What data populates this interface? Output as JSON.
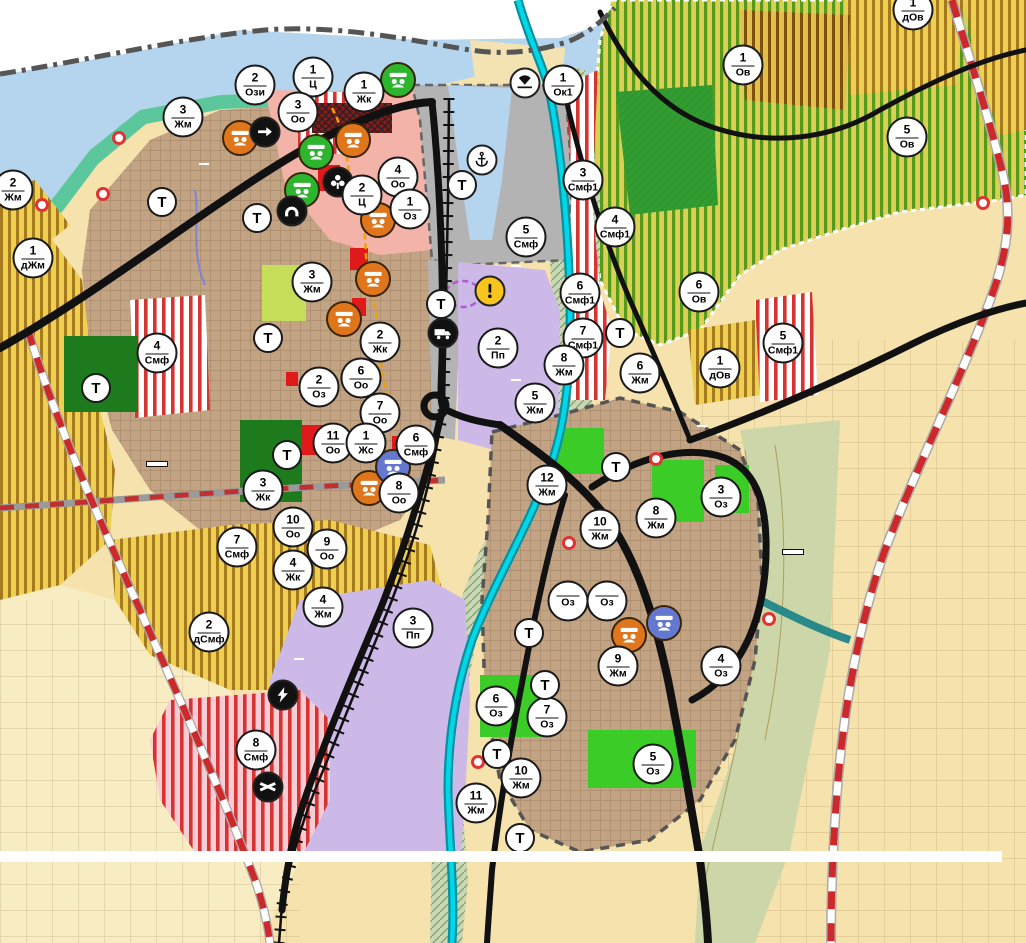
{
  "palette": {
    "river_blue": "#b5d5ee",
    "urban_brown": "#c2a384",
    "fields_peach": "#f6e2ad",
    "orchard_green": "#d8d154",
    "vineyard_yellow": "#eed04e",
    "mixed_use_red": "#d63333",
    "industrial_purple": "#cdb9e8",
    "port_gray": "#b3b3b3",
    "park_green": "#3ccc28",
    "dark_green": "#1d7a1d",
    "road_black": "#111111",
    "republican_road_red": "#c03030",
    "water_cyan": "#00d8e8",
    "center_pink": "#f3b3a9",
    "shore_teal": "#5cc79c",
    "warning_yellow": "#f7c51e"
  },
  "map": {
    "place_labels": [
      {
        "text": "ЛОМ",
        "x": 172,
        "y": 420,
        "cls": "city"
      },
      {
        "text": "ЛОМ",
        "x": 797,
        "y": 499,
        "cls": "city"
      },
      {
        "text": "кв. Младеново",
        "x": 800,
        "y": 525,
        "cls": "quarter"
      },
      {
        "text": "р. Дунав",
        "x": 417,
        "y": 14,
        "cls": "river-label"
      },
      {
        "text": "Пристанищен\nтерминал Лом",
        "x": 341,
        "y": 57,
        "cls": "port-label"
      }
    ],
    "street_labels": [
      {
        "text": "ул. \"А. СТАМБОЛИЙСКИ\"",
        "x": 204,
        "y": 164,
        "size": 20
      },
      {
        "text": "ул. \"ПРИСТАНИЩНА\"",
        "x": 516,
        "y": 266,
        "size": 20
      },
      {
        "text": "НАДЛЕЗ И МОСТ",
        "x": 516,
        "y": 380,
        "size": 21
      },
      {
        "text": "ул. \"КОВАЧИШКА\"",
        "x": 702,
        "y": 426,
        "size": 20
      },
      {
        "text": "ул. \"СОФИЙСКА\"",
        "x": 604,
        "y": 587,
        "size": 21
      },
      {
        "text": "ул. \"БЕЛОГРАДЧИШКО ШОСЕ\"",
        "x": 299,
        "y": 659,
        "size": 20
      }
    ],
    "road_labels": [
      {
        "text": "MON3138",
        "x": 618,
        "y": 42,
        "rotate": -33
      },
      {
        "text": "MON2135",
        "x": 656,
        "y": 258,
        "rotate": -62
      },
      {
        "text": "MON3139",
        "x": 158,
        "y": 490,
        "rotate": 7
      },
      {
        "text": "MON2136",
        "x": 497,
        "y": 797,
        "rotate": -78
      },
      {
        "text": "II-11",
        "x": 925,
        "y": 304,
        "rotate": 10,
        "cls": "big"
      }
    ],
    "land_boxes": [
      {
        "text": "Землище\n44238",
        "x": 157,
        "y": 464
      },
      {
        "text": "Землище\n44238",
        "x": 793,
        "y": 552
      }
    ],
    "zone_markers": [
      {
        "num": "2",
        "code": "Ози",
        "x": 255,
        "y": 85
      },
      {
        "num": "1",
        "code": "Ц",
        "x": 313,
        "y": 77
      },
      {
        "num": "1",
        "code": "Жк",
        "x": 364,
        "y": 92
      },
      {
        "num": "3",
        "code": "Оо",
        "x": 298,
        "y": 112
      },
      {
        "num": "3",
        "code": "Жм",
        "x": 183,
        "y": 117
      },
      {
        "num": "2",
        "code": "Жм",
        "x": 13,
        "y": 190
      },
      {
        "num": "1",
        "code": "дЖм",
        "x": 33,
        "y": 258
      },
      {
        "num": "4",
        "code": "Оо",
        "x": 398,
        "y": 177
      },
      {
        "num": "2",
        "code": "Ц",
        "x": 362,
        "y": 195
      },
      {
        "num": "1",
        "code": "Оз",
        "x": 410,
        "y": 209
      },
      {
        "num": "1",
        "code": "Ок1",
        "x": 563,
        "y": 85
      },
      {
        "num": "3",
        "code": "Смф1",
        "x": 583,
        "y": 180
      },
      {
        "num": "4",
        "code": "Смф1",
        "x": 615,
        "y": 227
      },
      {
        "num": "5",
        "code": "Смф",
        "x": 526,
        "y": 237
      },
      {
        "num": "1",
        "code": "Ов",
        "x": 743,
        "y": 65
      },
      {
        "num": "1",
        "code": "дОв",
        "x": 913,
        "y": 10
      },
      {
        "num": "5",
        "code": "Ов",
        "x": 907,
        "y": 137
      },
      {
        "num": "6",
        "code": "Ов",
        "x": 699,
        "y": 292
      },
      {
        "num": "1",
        "code": "дОв",
        "x": 720,
        "y": 368
      },
      {
        "num": "5",
        "code": "Смф1",
        "x": 783,
        "y": 343
      },
      {
        "num": "3",
        "code": "Жм",
        "x": 312,
        "y": 282
      },
      {
        "num": "2",
        "code": "Жк",
        "x": 380,
        "y": 342
      },
      {
        "num": "6",
        "code": "Оо",
        "x": 361,
        "y": 378
      },
      {
        "num": "2",
        "code": "Оз",
        "x": 319,
        "y": 387
      },
      {
        "num": "7",
        "code": "Оо",
        "x": 380,
        "y": 413
      },
      {
        "num": "11",
        "code": "Оо",
        "x": 333,
        "y": 443
      },
      {
        "num": "1",
        "code": "Жс",
        "x": 366,
        "y": 443
      },
      {
        "num": "6",
        "code": "Смф",
        "x": 416,
        "y": 445
      },
      {
        "num": "8",
        "code": "Оо",
        "x": 399,
        "y": 493
      },
      {
        "num": "3",
        "code": "Жк",
        "x": 263,
        "y": 490
      },
      {
        "num": "4",
        "code": "Смф",
        "x": 157,
        "y": 353
      },
      {
        "num": "10",
        "code": "Оо",
        "x": 293,
        "y": 527
      },
      {
        "num": "9",
        "code": "Оо",
        "x": 327,
        "y": 549
      },
      {
        "num": "4",
        "code": "Жк",
        "x": 293,
        "y": 570
      },
      {
        "num": "7",
        "code": "Смф",
        "x": 237,
        "y": 547
      },
      {
        "num": "4",
        "code": "Жм",
        "x": 323,
        "y": 607
      },
      {
        "num": "2",
        "code": "дСмф",
        "x": 209,
        "y": 632
      },
      {
        "num": "3",
        "code": "Пп",
        "x": 413,
        "y": 628
      },
      {
        "num": "8",
        "code": "Смф",
        "x": 256,
        "y": 750
      },
      {
        "num": "2",
        "code": "Пп",
        "x": 498,
        "y": 348
      },
      {
        "num": "6",
        "code": "Смф1",
        "x": 580,
        "y": 293
      },
      {
        "num": "7",
        "code": "Смф1",
        "x": 583,
        "y": 338
      },
      {
        "num": "8",
        "code": "Жм",
        "x": 564,
        "y": 365
      },
      {
        "num": "5",
        "code": "Жм",
        "x": 535,
        "y": 403
      },
      {
        "num": "6",
        "code": "Жм",
        "x": 640,
        "y": 373
      },
      {
        "num": "12",
        "code": "Жм",
        "x": 547,
        "y": 485
      },
      {
        "num": "8",
        "code": "Жм",
        "x": 656,
        "y": 518
      },
      {
        "num": "10",
        "code": "Жм",
        "x": 600,
        "y": 529
      },
      {
        "num": "3",
        "code": "Оз",
        "x": 721,
        "y": 497
      },
      {
        "num": "",
        "code": "Оз",
        "x": 568,
        "y": 601
      },
      {
        "num": "",
        "code": "Оз",
        "x": 607,
        "y": 601
      },
      {
        "num": "9",
        "code": "Жм",
        "x": 618,
        "y": 666
      },
      {
        "num": "4",
        "code": "Оз",
        "x": 721,
        "y": 666
      },
      {
        "num": "6",
        "code": "Оз",
        "x": 496,
        "y": 706
      },
      {
        "num": "7",
        "code": "Оз",
        "x": 547,
        "y": 717
      },
      {
        "num": "10",
        "code": "Жм",
        "x": 521,
        "y": 778
      },
      {
        "num": "11",
        "code": "Жм",
        "x": 476,
        "y": 803
      },
      {
        "num": "5",
        "code": "Оз",
        "x": 653,
        "y": 764
      },
      {
        "code": "Т",
        "cls": "t",
        "x": 462,
        "y": 185
      },
      {
        "code": "Т",
        "cls": "t",
        "x": 162,
        "y": 202
      },
      {
        "code": "Т",
        "cls": "t",
        "x": 257,
        "y": 218
      },
      {
        "code": "Т",
        "cls": "t",
        "x": 268,
        "y": 338
      },
      {
        "code": "Т",
        "cls": "t",
        "x": 96,
        "y": 388
      },
      {
        "code": "Т",
        "cls": "t",
        "x": 287,
        "y": 455
      },
      {
        "code": "Т",
        "cls": "t",
        "x": 441,
        "y": 304
      },
      {
        "code": "Т",
        "cls": "t",
        "x": 620,
        "y": 333
      },
      {
        "code": "Т",
        "cls": "t",
        "x": 616,
        "y": 467
      },
      {
        "code": "Т",
        "cls": "t",
        "x": 529,
        "y": 633
      },
      {
        "code": "Т",
        "cls": "t",
        "x": 545,
        "y": 685
      },
      {
        "code": "Т",
        "cls": "t",
        "x": 497,
        "y": 754
      },
      {
        "code": "Т",
        "cls": "t",
        "x": 520,
        "y": 838
      }
    ],
    "poi_markers": [
      {
        "icon": "heritage-icon",
        "x": 240,
        "y": 138,
        "bg": "#e0761c",
        "cls": "big"
      },
      {
        "icon": "heritage-icon",
        "x": 353,
        "y": 140,
        "bg": "#e0761c",
        "cls": "big"
      },
      {
        "icon": "heritage-icon",
        "x": 378,
        "y": 220,
        "bg": "#e0761c",
        "cls": "big"
      },
      {
        "icon": "heritage-icon",
        "x": 373,
        "y": 279,
        "bg": "#e0761c",
        "cls": "big"
      },
      {
        "icon": "heritage-icon",
        "x": 344,
        "y": 319,
        "bg": "#e0761c",
        "cls": "big"
      },
      {
        "icon": "heritage-icon",
        "x": 369,
        "y": 488,
        "bg": "#e0761c",
        "cls": "big"
      },
      {
        "icon": "heritage-icon",
        "x": 629,
        "y": 635,
        "bg": "#e0761c",
        "cls": "big"
      },
      {
        "icon": "heritage-icon",
        "x": 398,
        "y": 80,
        "bg": "#2db52d",
        "cls": "big"
      },
      {
        "icon": "heritage-icon",
        "x": 316,
        "y": 152,
        "bg": "#2db52d",
        "cls": "big"
      },
      {
        "icon": "heritage-icon",
        "x": 302,
        "y": 190,
        "bg": "#2db52d",
        "cls": "big"
      },
      {
        "icon": "heritage-icon",
        "x": 393,
        "y": 467,
        "bg": "#6478d0",
        "cls": "big"
      },
      {
        "icon": "heritage-icon",
        "x": 664,
        "y": 623,
        "bg": "#6478d0",
        "cls": "big"
      },
      {
        "icon": "one-way-icon",
        "x": 265,
        "y": 132,
        "bg": "#111",
        "fg": "#fff"
      },
      {
        "icon": "monument-club-icon",
        "x": 338,
        "y": 182,
        "bg": "#111",
        "fg": "#fff"
      },
      {
        "icon": "tunnel-icon",
        "x": 292,
        "y": 211,
        "bg": "#111",
        "fg": "#fff"
      },
      {
        "icon": "anchor-icon",
        "x": 482,
        "y": 160,
        "bg": "#fff",
        "fg": "#111"
      },
      {
        "icon": "truck-icon",
        "x": 443,
        "y": 333,
        "bg": "#111",
        "fg": "#fff"
      },
      {
        "icon": "power-icon",
        "x": 283,
        "y": 695,
        "bg": "#111",
        "fg": "#fff"
      },
      {
        "icon": "railway-crossing-icon",
        "x": 268,
        "y": 787,
        "bg": "#111",
        "fg": "#fff"
      },
      {
        "icon": "beach-icon",
        "x": 525,
        "y": 83,
        "bg": "#fff",
        "fg": "#111"
      },
      {
        "icon": "warning-icon",
        "x": 490,
        "y": 291,
        "bg": "#f7c51e",
        "fg": "#111"
      }
    ],
    "red_dots": [
      {
        "x": 119,
        "y": 138
      },
      {
        "x": 42,
        "y": 205
      },
      {
        "x": 103,
        "y": 194
      },
      {
        "x": 656,
        "y": 459
      },
      {
        "x": 569,
        "y": 543
      },
      {
        "x": 478,
        "y": 762
      },
      {
        "x": 769,
        "y": 619
      },
      {
        "x": 983,
        "y": 203
      }
    ]
  },
  "footer": {
    "segments": [
      {
        "t": "ОБОЗНАЧЕНИТЕ НА КАРТАТА УЛИЦИ: „АЛЕКСАНДЪР СТАМБОЛИЙСКИ“",
        "b": true
      },
      {
        "t": " - част от Републикански път (РП) II-11, "
      },
      {
        "t": "„ПРИСТАНИЩНА“",
        "b": true
      },
      {
        "t": " – част от РП II-11, "
      },
      {
        "t": "НАДЛЕЗ И МОСТ НАД РЕКА ЛОМ",
        "b": true
      },
      {
        "t": " – част от РП II-11, "
      },
      {
        "t": "„СОФИЙСКА“",
        "b": true
      },
      {
        "t": " – част от РП II-81, "
      },
      {
        "t": "„КОВАЧИШКА“",
        "b": true
      },
      {
        "t": " – част от РП II-11, "
      },
      {
        "t": "„БЕЛОГРАДЧИШКО ШОСЕ“",
        "b": true
      },
      {
        "t": " – част от РП III-114, "
      },
      {
        "t": "СА СОБСТВЕНОСТ НА АГЕНЦИЯ „ПЪТНА ИНФРАСТРУКТУРА“ (АПИ), КОЯТО ОТГОВАРЯ ЗА ТЯХНОТО ТЕКУЩО ПОДДЪРЖАНЕ, ОСНОВНИ РЕМОНТИ И РАЗРЕШИТЕЛНИ РЕЖИМИ.",
        "b": true
      }
    ]
  }
}
